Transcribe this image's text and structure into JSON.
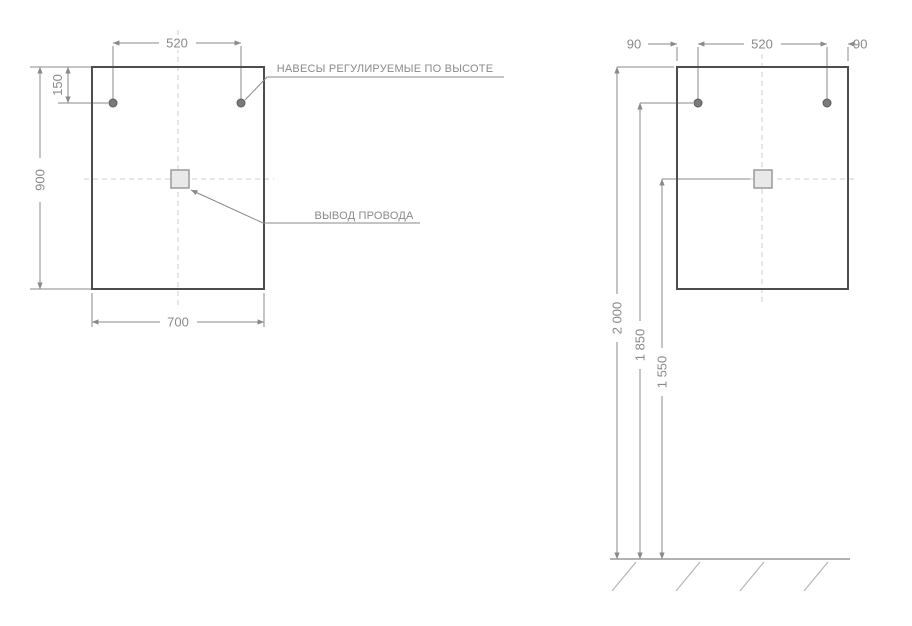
{
  "front_view": {
    "dims": {
      "hanger_spacing": "520",
      "hanger_top_offset": "150",
      "height": "900",
      "width": "700"
    },
    "labels": {
      "hangers": "НАВЕСЫ РЕГУЛИРУЕМЫЕ ПО ВЫСОТЕ",
      "wire_outlet": "ВЫВОД ПРОВОДА"
    }
  },
  "installation_view": {
    "dims": {
      "hanger_edge_left": "90",
      "hanger_spacing": "520",
      "hanger_edge_right": "90",
      "height_mirror_top": "2 000",
      "height_hangers": "1 850",
      "height_wire_outlet": "1 550"
    }
  },
  "colors": {
    "outline": "#4d4d4d",
    "dimension": "#8a8a8a",
    "centerline": "#cfcfcf",
    "dot_fill": "#7a7a7a",
    "square_fill": "#e9e9e9",
    "floor_hatch": "#b5b5b5",
    "background": "#ffffff"
  }
}
